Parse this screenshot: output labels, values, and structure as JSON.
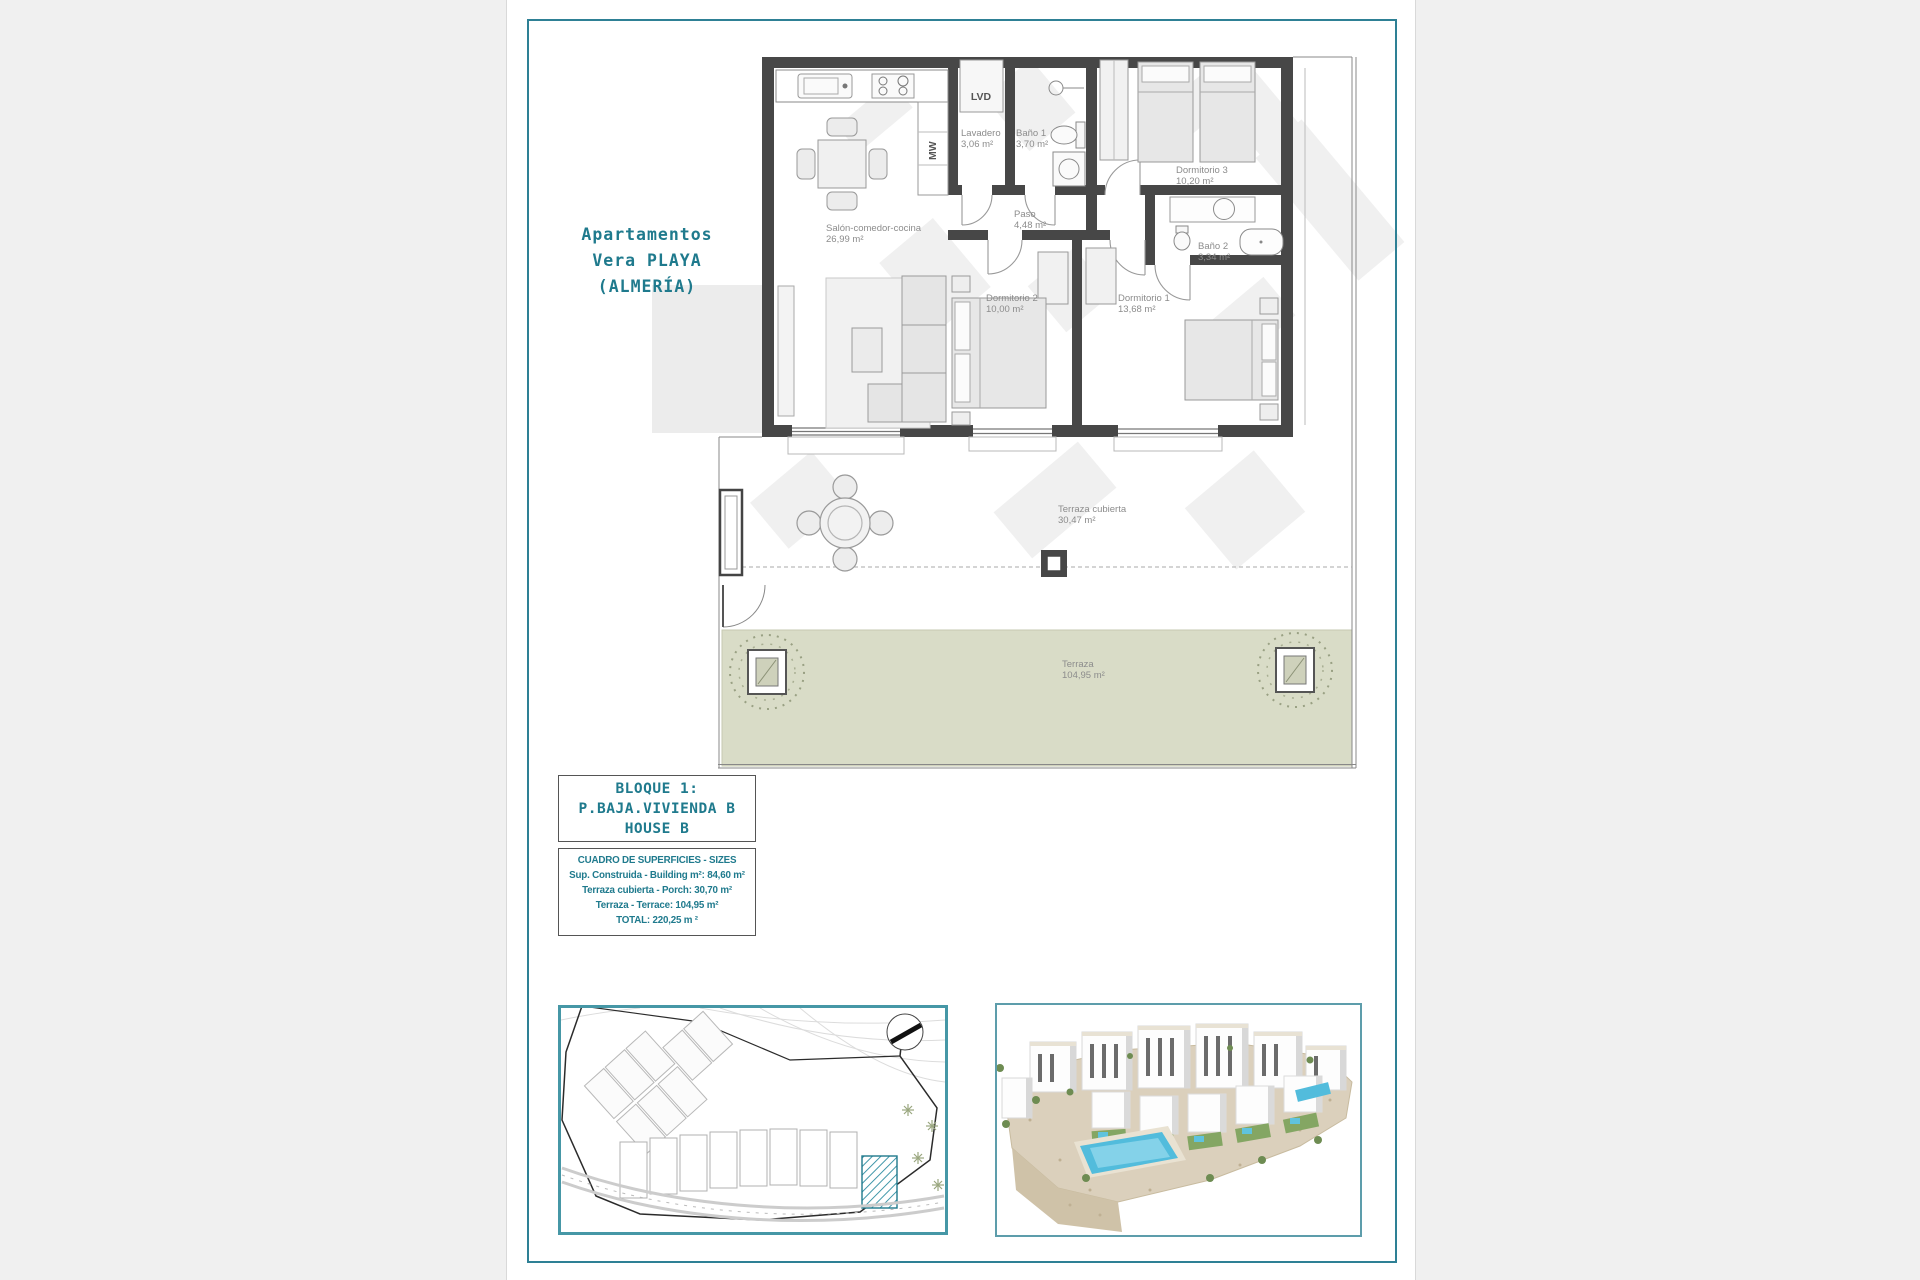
{
  "title": {
    "lines": [
      "Apartamentos",
      "Vera PLAYA",
      "(ALMERÍA)"
    ]
  },
  "floor_plan": {
    "rooms": [
      {
        "name": "Salón-comedor-cocina",
        "area": "26,99 m²"
      },
      {
        "name": "Lavadero",
        "area": "3,06 m²"
      },
      {
        "name": "Baño 1",
        "area": "3,70 m²"
      },
      {
        "name": "Paso",
        "area": "4,48 m²"
      },
      {
        "name": "Dormitorio 3",
        "area": "10,20 m²"
      },
      {
        "name": "Baño 2",
        "area": "3,34 m²"
      },
      {
        "name": "Dormitorio 2",
        "area": "10,00 m²"
      },
      {
        "name": "Dormitorio 1",
        "area": "13,68 m²"
      },
      {
        "name": "Terraza cubierta",
        "area": "30,47 m²"
      },
      {
        "name": "Terraza",
        "area": "104,95 m²"
      }
    ],
    "appliances": [
      "LVD",
      "MW"
    ]
  },
  "block_label": {
    "lines": [
      "BLOQUE 1:",
      "P.BAJA.VIVIENDA B",
      "HOUSE B"
    ]
  },
  "sizes_table": {
    "title": "CUADRO DE SUPERFICIES  - SIZES",
    "rows": [
      "Sup. Construida  - Building m²: 84,60 m²",
      "Terraza cubierta  - Porch: 30,70 m²",
      "Terraza - Terrace: 104,95 m²",
      "TOTAL:  220,25 m ²"
    ]
  },
  "colors": {
    "teal_text": "#1f7a8d",
    "frame_border": "#2e8095",
    "site_box_border": "#4697a6",
    "wall": "#474747",
    "terrace_green": "#d9dcc7",
    "plan_label_gray": "#8c8c8c",
    "pool_blue": "#52bcdc"
  }
}
